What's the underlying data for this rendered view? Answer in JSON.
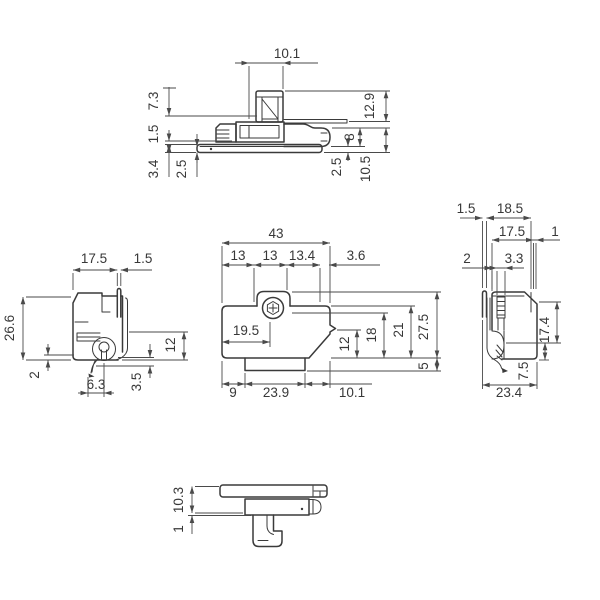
{
  "drawing": {
    "type": "engineering-multiview-part-drawing",
    "line_color": "#3a3a3a",
    "dim_color": "#4a4a4a",
    "background": "#ffffff",
    "views": {
      "top": {
        "d10_1": "10.1",
        "d7_3": "7.3",
        "d1_5": "1.5",
        "d3_4": "3.4",
        "d2_5_left": "2.5",
        "d12_9": "12.9",
        "d8": "8",
        "d2_5_right": "2.5",
        "d10_5": "10.5"
      },
      "left": {
        "d17_5": "17.5",
        "d1_5": "1.5",
        "d26_6": "26.6",
        "d2": "2",
        "d6_3": "6.3",
        "d3_5": "3.5",
        "d12": "12"
      },
      "front": {
        "d43": "43",
        "d13a": "13",
        "d13b": "13",
        "d13_4": "13.4",
        "d3_6": "3.6",
        "d19_5": "19.5",
        "d12": "12",
        "d18": "18",
        "d21": "21",
        "d27_5": "27.5",
        "d5": "5",
        "d9": "9",
        "d23_9": "23.9",
        "d10_1": "10.1"
      },
      "right": {
        "d1_5": "1.5",
        "d18_5": "18.5",
        "d17_5": "17.5",
        "d1": "1",
        "d2": "2",
        "d3_3": "3.3",
        "d17_4": "17.4",
        "d7_5": "7.5",
        "d23_4": "23.4"
      },
      "bottom": {
        "d10_3": "10.3",
        "d1": "1"
      }
    }
  }
}
